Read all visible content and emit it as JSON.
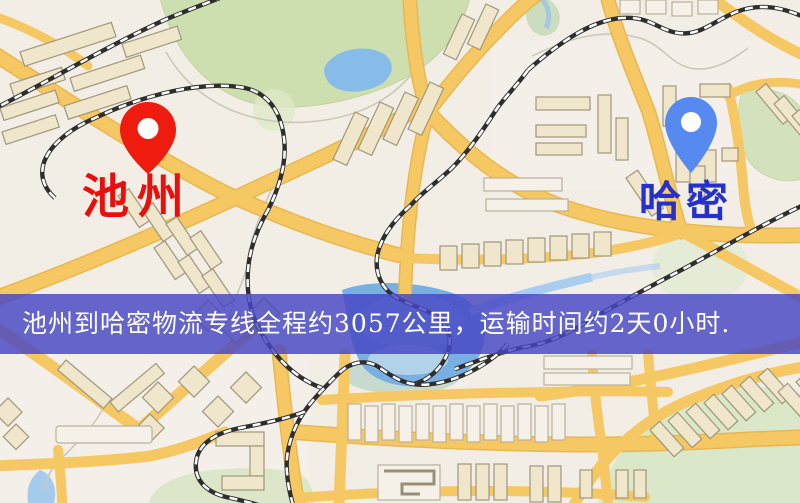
{
  "page": {
    "width_px": 800,
    "height_px": 503,
    "kind": "static-map-route-image"
  },
  "markers": [
    {
      "id": "origin",
      "label": "池州",
      "pin_color": "#ee1b0e",
      "label_color": "#e8100c",
      "icon": "map-pin-icon"
    },
    {
      "id": "destination",
      "label": "哈密",
      "pin_color": "#568af0",
      "label_color": "#2531c8",
      "icon": "map-pin-icon"
    }
  ],
  "banner": {
    "text": "池州到哈密物流专线全程约3057公里，运输时间约2天0小时.",
    "background_color": "rgba(70,70,195,0.82)",
    "text_color": "#ffffff"
  },
  "route": {
    "origin": "池州",
    "destination": "哈密",
    "distance_text": "约3057公里",
    "duration_text": "约2天0小时"
  },
  "map_palette": {
    "background": "#f2eee6",
    "road_fill": "#f6c863",
    "road_border": "#e8b850",
    "building_fill": "#efe6cb",
    "building_border": "#a0977b",
    "green_area": "#cddfaf",
    "water": "#87bce8",
    "railway": "#2e2e2e"
  }
}
